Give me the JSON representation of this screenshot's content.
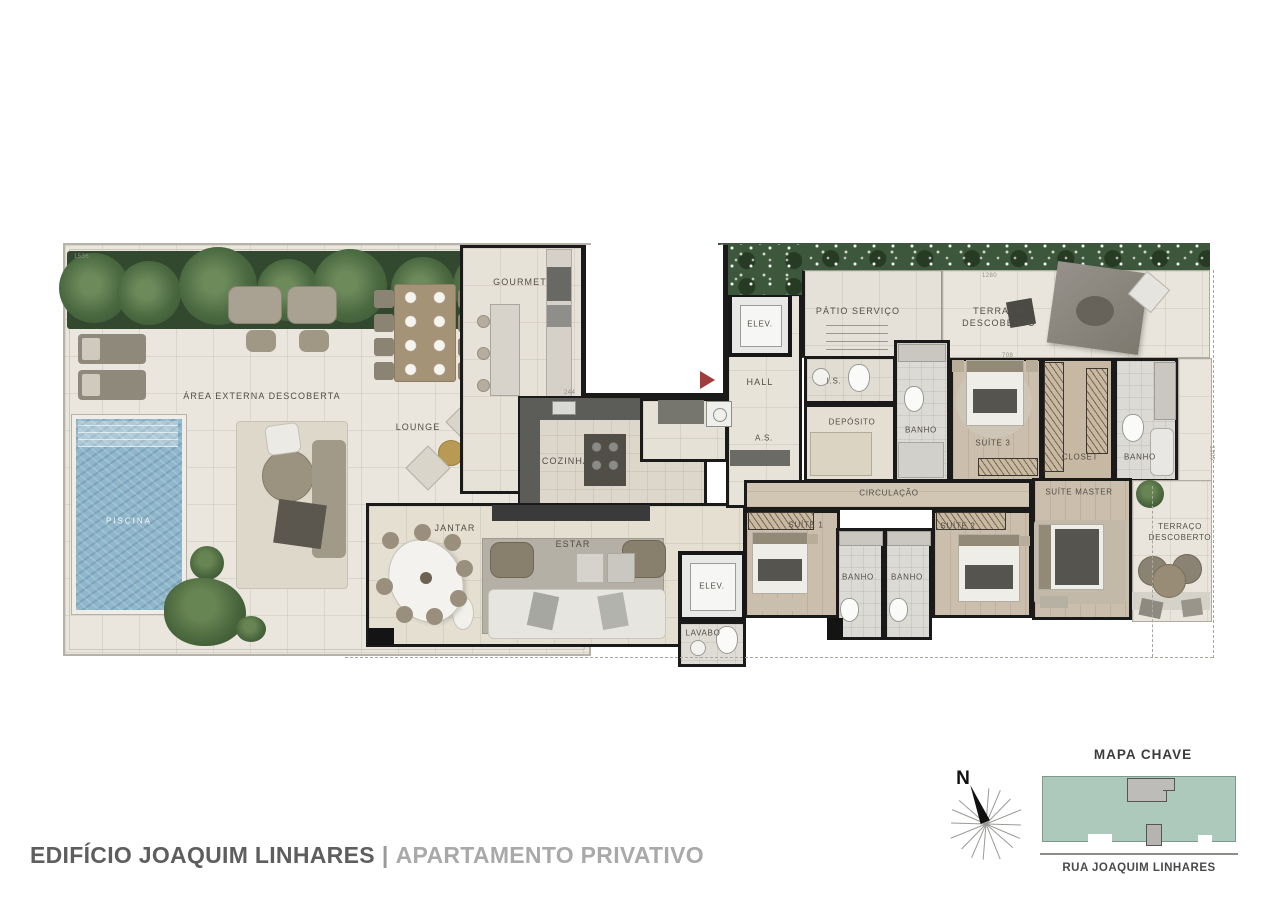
{
  "plan_labels": {
    "piscina": "PISCINA",
    "area_externa": "ÁREA EXTERNA DESCOBERTA",
    "lounge": "LOUNGE",
    "gourmet": "GOURMET",
    "cozinha": "COZINHA",
    "jantar": "JANTAR",
    "estar": "ESTAR",
    "elev": "ELEV.",
    "hall": "HALL",
    "area_servico": "A.S.",
    "patio_servico": "PÁTIO SERVIÇO",
    "terraco_descoberto": "TERRAÇO DESCOBERTO",
    "is": "I.S.",
    "deposito": "DEPÓSITO",
    "banho": "BANHO",
    "suite_3": "SUÍTE 3",
    "closet": "CLOSET",
    "circulacao": "CIRCULAÇÃO",
    "suite_master": "SUÍTE MASTER",
    "suite_1": "SUÍTE 1",
    "suite_2": "SUÍTE 2",
    "lavabo": "LAVABO"
  },
  "dimensions": {
    "top_left": "1536",
    "top_right": "1280",
    "suite3_width": "708",
    "kitchen": "244",
    "right_side": "1205"
  },
  "footer": {
    "building": "EDIFÍCIO JOAQUIM LINHARES",
    "separator": "|",
    "unit": "APARTAMENTO PRIVATIVO"
  },
  "map_key": {
    "title": "MAPA CHAVE",
    "street": "RUA JOAQUIM LINHARES"
  },
  "compass": {
    "north": "N"
  },
  "colors": {
    "wall": "#1a1a1a",
    "deck": "#eae6dd",
    "pool_water": "#8fb6ca",
    "hedge_green": "#3d573c",
    "wood_floor": "#cbbeac",
    "entrance_arrow": "#a23c3c",
    "map_green": "#adc9bc",
    "map_unit_gray": "#bdbcb8",
    "title_dark": "#5e5e5e",
    "title_light": "#a9a9a9"
  }
}
